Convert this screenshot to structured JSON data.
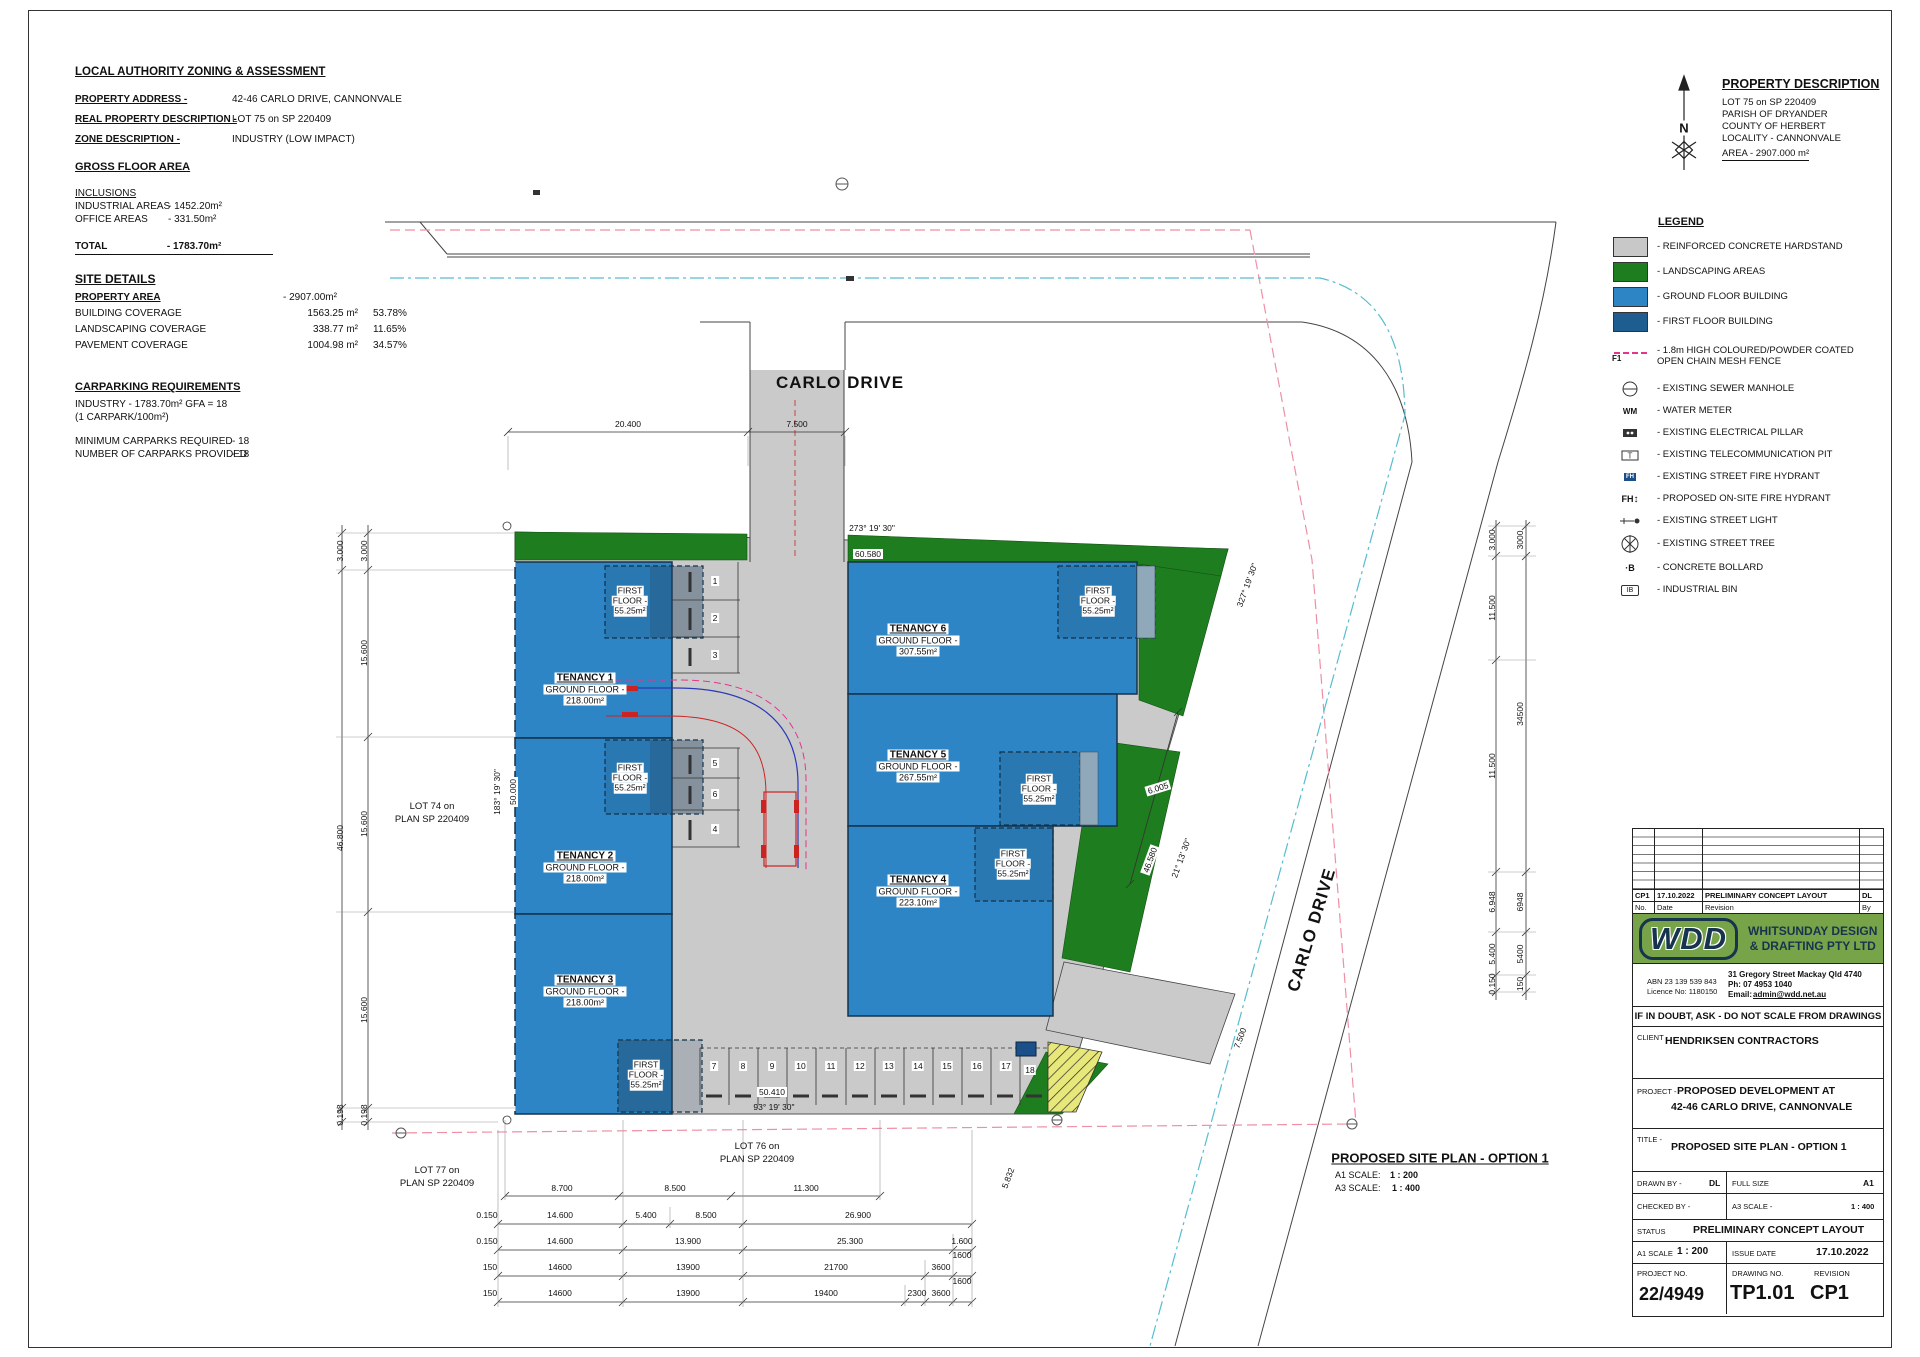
{
  "colors": {
    "hardstand": "#cacaca",
    "landscaping": "#1e7d1e",
    "ground_floor": "#2d85c5",
    "first_floor": "#1d5d8f",
    "fence_pink": "#e6338e",
    "sewer_pink": "#ef8fa4",
    "water_cyan": "#57bcd0",
    "wdd_green": "#77a349",
    "wdd_navy": "#17344f",
    "truck_red": "#cc2222",
    "path_blue": "#2b39b5",
    "hatch_yellow": "#e8e87a"
  },
  "zoning": {
    "title": "LOCAL AUTHORITY ZONING & ASSESSMENT",
    "rows": [
      {
        "label": "PROPERTY ADDRESS -",
        "value": "42-46 CARLO DRIVE, CANNONVALE"
      },
      {
        "label": "REAL PROPERTY DESCRIPTION -",
        "value": "LOT 75 on SP 220409"
      },
      {
        "label": "ZONE DESCRIPTION -",
        "value": "INDUSTRY (LOW IMPACT)"
      }
    ]
  },
  "gfa": {
    "title": "GROSS FLOOR AREA",
    "inclusions_label": "INCLUSIONS",
    "rows": [
      {
        "label": "INDUSTRIAL AREAS",
        "value": "- 1452.20m²"
      },
      {
        "label": "OFFICE AREAS",
        "value": "-  331.50m²"
      }
    ],
    "total_label": "TOTAL",
    "total_value": "- 1783.70m²"
  },
  "site_details": {
    "title": "SITE DETAILS",
    "area_label": "PROPERTY AREA",
    "area_value": "- 2907.00m²",
    "rows": [
      {
        "label": "BUILDING COVERAGE",
        "value": "1563.25 m²",
        "pct": "53.78%"
      },
      {
        "label": "LANDSCAPING COVERAGE",
        "value": "338.77 m²",
        "pct": "11.65%"
      },
      {
        "label": "PAVEMENT COVERAGE",
        "value": "1004.98 m²",
        "pct": "34.57%"
      }
    ]
  },
  "carparking": {
    "title": "CARPARKING REQUIREMENTS",
    "line1": "INDUSTRY - 1783.70m² GFA = 18",
    "line2": "(1 CARPARK/100m²)",
    "rows": [
      {
        "label": "MINIMUM CARPARKS REQUIRED",
        "value": "- 18"
      },
      {
        "label": "NUMBER OF CARPARKS PROVIDED",
        "value": "- 18"
      }
    ]
  },
  "property_description": {
    "title": "PROPERTY DESCRIPTION",
    "lines": [
      "LOT 75   on SP 220409",
      "PARISH OF  DRYANDER",
      "COUNTY OF  HERBERT",
      "LOCALITY -  CANNONVALE"
    ],
    "area_line": "AREA -  2907.000 m²",
    "north_label": "N"
  },
  "legend": {
    "title": "LEGEND",
    "items": [
      {
        "icon": "hardstand-swatch",
        "label": "- REINFORCED CONCRETE HARDSTAND"
      },
      {
        "icon": "landscaping-swatch",
        "label": "- LANDSCAPING AREAS"
      },
      {
        "icon": "ground-floor-swatch",
        "label": "- GROUND FLOOR BUILDING"
      },
      {
        "icon": "first-floor-swatch",
        "label": "- FIRST FLOOR BUILDING"
      },
      {
        "icon": "fence-line",
        "glyph": "F1",
        "label": "- 1.8m HIGH COLOURED/POWDER COATED OPEN CHAIN MESH FENCE"
      },
      {
        "icon": "sewer-manhole",
        "label": "- EXISTING SEWER MANHOLE"
      },
      {
        "icon": "water-meter",
        "glyph": "WM",
        "label": "- WATER METER"
      },
      {
        "icon": "electrical-pillar",
        "label": "- EXISTING ELECTRICAL PILLAR"
      },
      {
        "icon": "telecommunication-pit",
        "glyph": "T",
        "label": "- EXISTING TELECOMMUNICATION PIT"
      },
      {
        "icon": "street-fire-hydrant",
        "glyph": "FH",
        "label": "- EXISTING STREET FIRE HYDRANT"
      },
      {
        "icon": "onsite-fire-hydrant",
        "glyph": "FH",
        "label": "- PROPOSED ON-SITE FIRE HYDRANT"
      },
      {
        "icon": "street-light",
        "label": "- EXISTING STREET LIGHT"
      },
      {
        "icon": "street-tree",
        "label": "- EXISTING STREET TREE"
      },
      {
        "icon": "concrete-bollard",
        "glyph": "·B",
        "label": "- CONCRETE BOLLARD"
      },
      {
        "icon": "industrial-bin",
        "glyph": "IB",
        "label": "- INDUSTRIAL BIN"
      }
    ]
  },
  "plan": {
    "road_top": "CARLO DRIVE",
    "road_right": "CARLO DRIVE",
    "tenancies": [
      {
        "name": "TENANCY 1",
        "line": "GROUND FLOOR -",
        "area": "218.00m²"
      },
      {
        "name": "TENANCY 2",
        "line": "GROUND FLOOR -",
        "area": "218.00m²"
      },
      {
        "name": "TENANCY 3",
        "line": "GROUND FLOOR -",
        "area": "218.00m²"
      },
      {
        "name": "TENANCY 4",
        "line": "GROUND FLOOR -",
        "area": "223.10m²"
      },
      {
        "name": "TENANCY 5",
        "line": "GROUND FLOOR -",
        "area": "267.55m²"
      },
      {
        "name": "TENANCY 6",
        "line": "GROUND FLOOR -",
        "area": "307.55m²"
      }
    ],
    "first_floor": {
      "l1": "FIRST",
      "l2": "FLOOR -",
      "area": "55.25m²"
    },
    "carparks": [
      "1",
      "2",
      "3",
      "4",
      "5",
      "6",
      "7",
      "8",
      "9",
      "10",
      "11",
      "12",
      "13",
      "14",
      "15",
      "16",
      "17",
      "18"
    ],
    "lots": {
      "lot74": [
        "LOT  74  on",
        "PLAN  SP 220409"
      ],
      "lot76": [
        "LOT  76  on",
        "PLAN  SP 220409"
      ],
      "lot77": [
        "LOT  77  on",
        "PLAN  SP 220409"
      ]
    },
    "angles": {
      "top": "273° 19' 30\"",
      "top_len": "60.580",
      "left": "183° 19' 30\"",
      "left_len": "50.000",
      "bottom": "93° 19' 30\"",
      "bottom_len": "50.410",
      "right": "327° 19' 30\"",
      "slant": "21° 13' 30\"",
      "slant_len": "46.580",
      "green_w": "6.005",
      "drive_w": "7.500",
      "extra": "5.832"
    },
    "dims_top": [
      "20.400",
      "7.500"
    ],
    "dims_left_outer": [
      "3.000",
      "46.800",
      "0.198"
    ],
    "dims_left_inner": [
      "3.000",
      "15.600",
      "15.600",
      "15.600",
      "0.198"
    ],
    "dims_right_inner": [
      "3.000",
      "11.500",
      "11.500",
      "6.948",
      "5.400",
      "0.150"
    ],
    "dims_right_outer": [
      "3000",
      "34500",
      "6948",
      "5400",
      "150"
    ],
    "dim_rows": [
      [
        "8.700",
        "8.500",
        "11.300"
      ],
      [
        "0.150",
        "14.600",
        "5.400",
        "8.500",
        "26.900"
      ],
      [
        "0.150",
        "14.600",
        "13.900",
        "25.300",
        "1.600"
      ],
      [
        "150",
        "14600",
        "13900",
        "21700",
        "3600",
        "1600"
      ],
      [
        "150",
        "14600",
        "13900",
        "19400",
        "2300",
        "3600",
        "1600"
      ]
    ],
    "caption": {
      "title": "PROPOSED SITE PLAN - OPTION 1",
      "a1": "A1 SCALE:",
      "a1v": "1 : 200",
      "a3": "A3 SCALE:",
      "a3v": "1 : 400"
    }
  },
  "titleblock": {
    "revision_header": {
      "no": "No.",
      "date": "Date",
      "revision": "Revision",
      "by": "By"
    },
    "revision_row": {
      "no": "CP1",
      "date": "17.10.2022",
      "revision": "PRELIMINARY CONCEPT LAYOUT",
      "by": "DL"
    },
    "logo": "WDD",
    "company_l1": "WHITSUNDAY DESIGN",
    "company_l2": "& DRAFTING PTY LTD",
    "abn": "ABN 23 139 539 843",
    "licence": "Licence No: 1180150",
    "addr1": "31 Gregory Street Mackay Qld 4740",
    "addr2": "Ph: 07 4953 1040",
    "addr3_label": "Email:",
    "addr3": "admin@wdd.net.au",
    "disclaimer": "IF IN DOUBT, ASK - DO NOT SCALE FROM DRAWINGS",
    "client_label": "CLIENT -",
    "client": "HENDRIKSEN CONTRACTORS",
    "project_label": "PROJECT -",
    "project_l1": "PROPOSED DEVELOPMENT AT",
    "project_l2": "42-46 CARLO DRIVE, CANNONVALE",
    "title_label": "TITLE -",
    "title": "PROPOSED SITE PLAN - OPTION 1",
    "drawn_label": "DRAWN BY -",
    "drawn": "DL",
    "fullsize_label": "FULL SIZE",
    "fullsize": "A1",
    "checked_label": "CHECKED BY -",
    "a3_label": "A3 SCALE -",
    "a3": "1 : 400",
    "status_label": "STATUS",
    "status": "PRELIMINARY CONCEPT LAYOUT",
    "a1_label": "A1 SCALE",
    "a1": "1 : 200",
    "issue_label": "ISSUE DATE",
    "issue": "17.10.2022",
    "projno_label": "PROJECT NO.",
    "projno": "22/4949",
    "dwgno_label": "DRAWING NO.",
    "dwgno": "TP1.01",
    "rev_label": "REVISION",
    "rev": "CP1"
  }
}
